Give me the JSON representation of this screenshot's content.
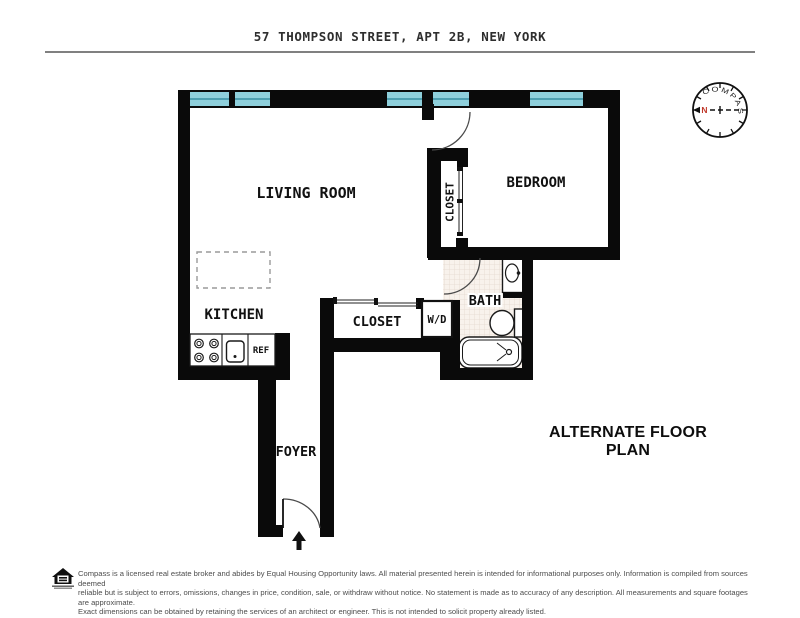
{
  "title": "57 THOMPSON STREET, APT 2B, NEW YORK",
  "plan_label": "ALTERNATE FLOOR PLAN",
  "compass": {
    "label": "COMPASS",
    "north": "N"
  },
  "rooms": {
    "living_room": "LIVING ROOM",
    "kitchen": "KITCHEN",
    "bedroom": "BEDROOM",
    "bedroom_closet": "CLOSET",
    "hall_closet": "CLOSET",
    "washer_dryer": "W/D",
    "bath": "BATH",
    "foyer": "FOYER",
    "fridge": "REF"
  },
  "footer": {
    "lines": [
      "Compass is a licensed real estate broker and abides by Equal Housing Opportunity laws. All material presented herein is intended for informational purposes only. Information is compiled from sources deemed",
      "reliable but is subject to errors, omissions, changes in price, condition, sale, or withdraw without notice. No statement is made as to accuracy of any description. All measurements and square footages are approximate.",
      "Exact dimensions can be obtained by retaining the services of an architect or engineer. This is not intended to solicit property already listed."
    ]
  },
  "colors": {
    "wall": "#0a0a0a",
    "window": "#8ecfdb",
    "window-stripe": "#4d9fb0",
    "north": "#c0392b",
    "tile-bg": "#f8f2ec",
    "tile-line": "#e4d8cf",
    "arc": "#4a4a4a",
    "muted": "#4d4d4d",
    "rule": "#808080"
  }
}
